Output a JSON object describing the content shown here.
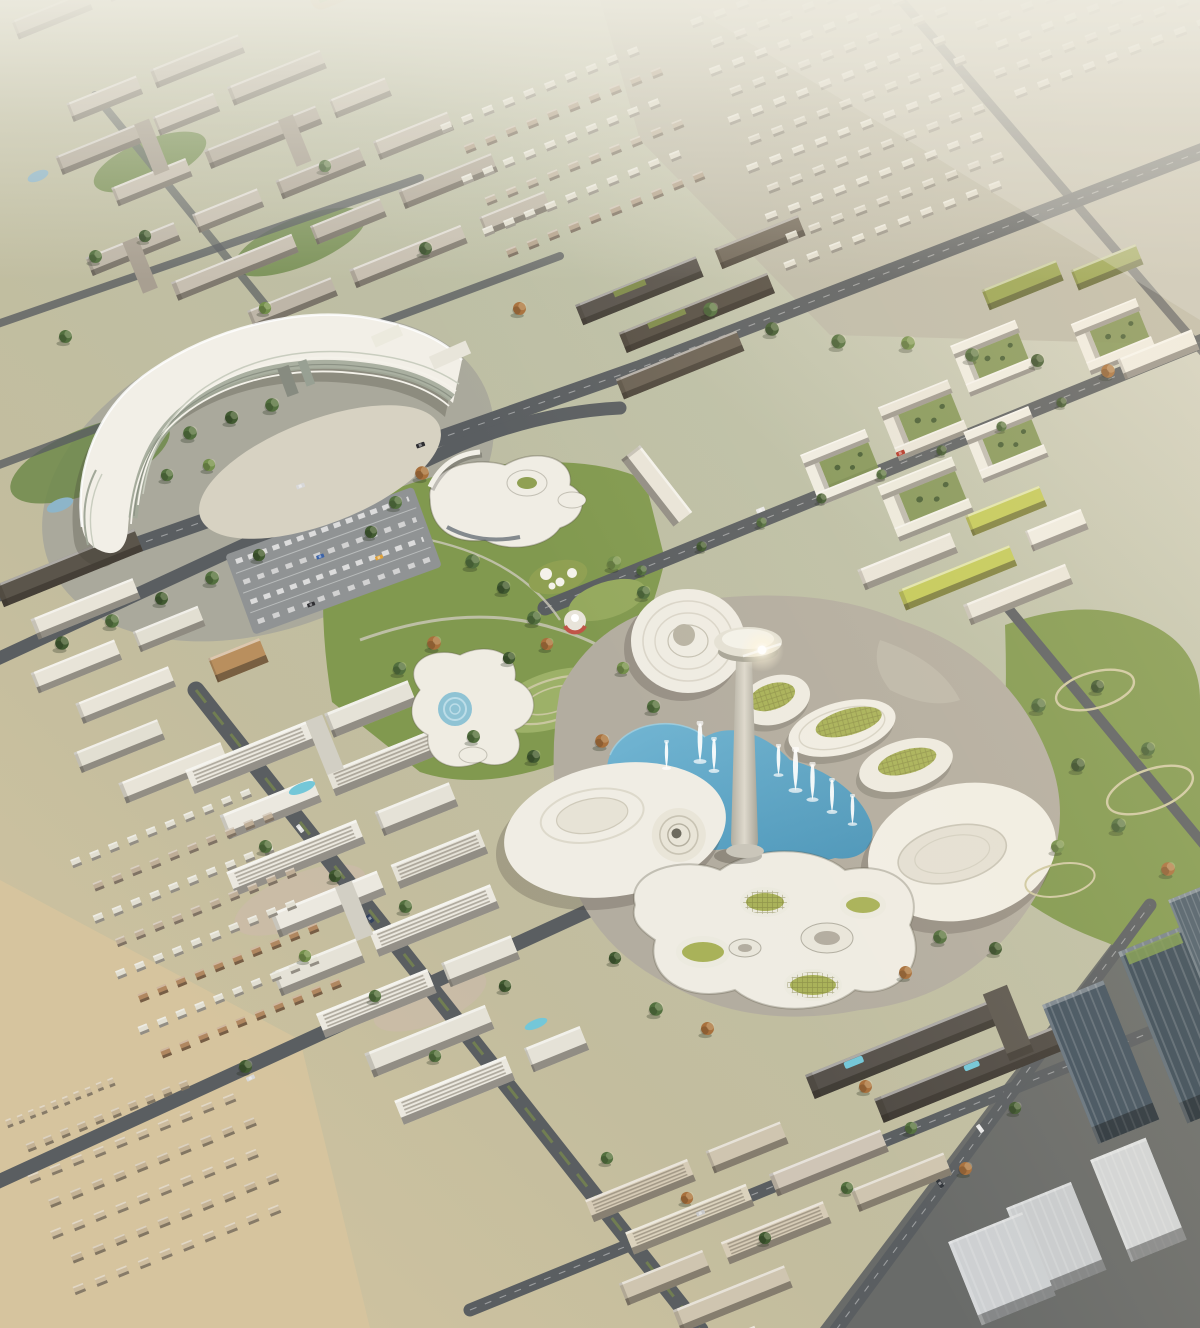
{
  "scene": {
    "type": "aerial-architectural-rendering",
    "description": "Aerial daytime rendering of a planned mixed-use city district: a curved crescent-shaped white tower at left, a central park with organic blob pavilions and a carousel, a lake with fountains and a mushroom-shaped observation tower surrounded by oval lily-pad halls with green planted roofs, dense mid-rise residential blocks, a villa field fading into haze at the top right, white courtyard housing at the bottom left, and dark glass office towers in the lower right corner.",
    "visible_text": "none",
    "lighting": "warm low sun from the right with haze toward the horizon at top"
  },
  "palette": {
    "haze": "#eceade",
    "ground": "#c6c0ab",
    "ground_warm": "#d8c7a2",
    "plaza": "#b3ada0",
    "sand": "#d7d2c2",
    "road": "#5a5e61",
    "lane_marking": "#c8cac9",
    "park_green": "#81994f",
    "lawn": "#9db168",
    "tree_green": "#53703f",
    "tree_dark": "#415a31",
    "tree_light": "#74904c",
    "tree_autumn": "#a8703c",
    "water": "#5aa6c6",
    "pool": "#74c7d8",
    "building_white": "#efece3",
    "building_beige": "#c7bfb1",
    "building_dark": "#57524c",
    "building_brown": "#6a6154",
    "bronze": "#b98f5e",
    "roof_green": "#c3ca58",
    "roof_garden": "#96a24e",
    "pad_green": "#a9b259",
    "glass": "#42525f",
    "office_light": "#d2d5d6",
    "fountain": "#ffffff"
  }
}
